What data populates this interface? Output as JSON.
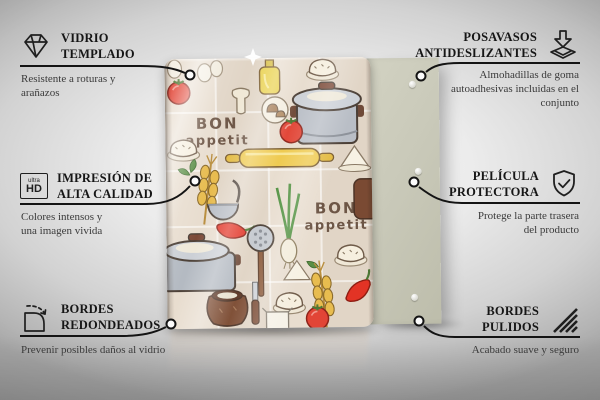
{
  "scene": {
    "kind": "glass cutting board product infographic",
    "background_accent": "#d6d6d6",
    "connector_color": "#141414"
  },
  "product": {
    "glass_board": {
      "base_color": "#e8ddcf",
      "design_text_1": {
        "line1": "BON",
        "line2": "appetit"
      },
      "design_text_2": {
        "line1": "BON",
        "line2": "appetit"
      },
      "design_items": [
        "tomato",
        "eggs",
        "oil-bottle",
        "dumplings",
        "mushroom-slice",
        "mushrooms",
        "cooking-pot",
        "rolling-pin",
        "wheat",
        "ladle",
        "chili-pepper",
        "herbs",
        "skimmer",
        "spring-onion",
        "flour-pile",
        "clay-jug",
        "knife",
        "milk-jug"
      ]
    },
    "backing_panel": {
      "color": "#c9c9b9",
      "pads_count": 3
    }
  },
  "callouts": {
    "top_left": {
      "icon": "diamond-icon",
      "title": "VIDRIO TEMPLADO",
      "description": "Resistente a roturas y arañazos"
    },
    "top_right": {
      "icon": "arrow-down-tray-icon",
      "title": "POSAVASOS ANTIDESLIZANTES",
      "description": "Almohadillas de goma autoadhesivas incluidas en el conjunto"
    },
    "middle_left": {
      "icon": "ultra-hd-icon",
      "icon_label_top": "ultra",
      "icon_label_bottom": "HD",
      "title": "IMPRESIÓN DE ALTA CALIDAD",
      "description": "Colores intensos y una imagen vivida"
    },
    "middle_right": {
      "icon": "shield-check-icon",
      "title": "PELÍCULA PROTECTORA",
      "description": "Protege la parte trasera del producto"
    },
    "bottom_left": {
      "icon": "rounded-corner-icon",
      "title": "BORDES REDONDEADOS",
      "description": "Prevenir posibles daños al vidrio"
    },
    "bottom_right": {
      "icon": "diagonal-hatch-icon",
      "title": "BORDES PULIDOS",
      "description": "Acabado suave y seguro"
    }
  }
}
